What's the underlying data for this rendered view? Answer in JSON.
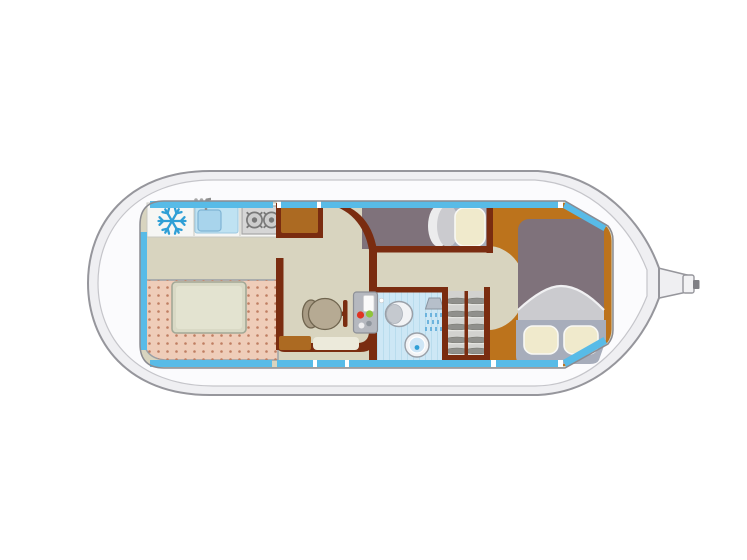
{
  "diagram": {
    "kind": "boat-deck-floor-plan",
    "rooms": {
      "galley": {
        "fixtures": [
          "refrigerator",
          "sink-with-faucet",
          "two-burner-stove"
        ]
      },
      "saloon": {
        "fixtures": [
          "u-shaped-sofa",
          "dinette-table"
        ]
      },
      "helm": {
        "fixtures": [
          "helm-seat",
          "steering-wheel",
          "instrument-panel",
          "entry-steps-top",
          "entry-steps-bottom"
        ]
      },
      "aft_berth": {
        "fixtures": [
          "single-berth",
          "pillow",
          "blanket"
        ]
      },
      "bathroom": {
        "fixtures": [
          "toilet",
          "shower",
          "washbasin",
          "door-knob"
        ]
      },
      "wardrobe": {
        "fixtures": [
          "slatted-shelves"
        ]
      },
      "bow_cabin": {
        "fixtures": [
          "double-bed",
          "blanket",
          "pillow-left",
          "pillow-right"
        ]
      },
      "exterior": {
        "features": [
          "hull",
          "deck",
          "window-band",
          "bow-fitting"
        ]
      }
    },
    "icons": {
      "fridge": "snowflake-icon"
    }
  },
  "palette": {
    "background": "#ffffff",
    "hull_fill": "#efeff2",
    "hull_stroke": "#96969c",
    "deck_fill": "#fbfbfd",
    "deck_stroke": "#c5c5ca",
    "cabin_outline": "#8b8b91",
    "window_cyan": "#58bbe7",
    "floor_saloon": "#d8d4bf",
    "floor_bow": "#bc731c",
    "floor_bathroom": "#cde7f5",
    "counter_white": "#f6f6f4",
    "wood_dark": "#7a2c10",
    "wood_step": "#ac6a22",
    "step_platform": "#eceadb",
    "sofa_pink": "#efcdb9",
    "sofa_dot": "#bf7e62",
    "table_fill": "#d9d9c5",
    "table_stroke": "#a2a896",
    "seat_fill": "#b6aa93",
    "seat_back": "#a89b84",
    "console_gray": "#b5b8bf",
    "console_screen": "#fafafa",
    "indicator_red": "#e03322",
    "indicator_green": "#8fc43c",
    "bed_mauve": "#7f727b",
    "blanket_gray": "#cbcbcf",
    "pillow_cream": "#f0eacc",
    "pillow_frame": "#a7adbb",
    "wardrobe_bg": "#d2d2cf",
    "slat_gray": "#90908c",
    "stove_gray": "#d6d6d6",
    "burner_gray": "#787878",
    "sink_blue": "#bfe2f2",
    "sink_inner": "#a8d4ec",
    "snowflake_blue": "#2f9fd6",
    "fixture_white": "#f2f3f5",
    "fixture_gray": "#c5c9cf",
    "basin_dot": "#2f9fd6",
    "bow_tip_gray": "#808085"
  }
}
